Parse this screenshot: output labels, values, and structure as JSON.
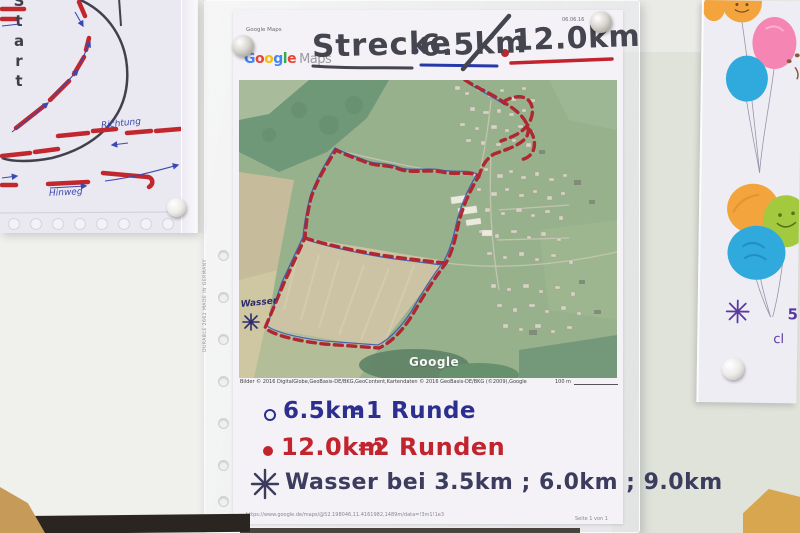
{
  "scene": {
    "description": "Photo of running-event route sheets pinned to a wall",
    "wall_color": "#eaebe7",
    "wall_shaded_color": "#e0e3da",
    "shelf_shadow_color": "#2b2521",
    "wood_corner_color": "#c69b59"
  },
  "left_page": {
    "start_label": "Start",
    "direction_label": "Richtung",
    "outbound_label": "Hinweg",
    "ink_color": "#3f3f4a",
    "route_color": "#c1272d",
    "arrow_color": "#3a49b0"
  },
  "main_page": {
    "print_header": {
      "app_label": "Google Maps",
      "date_label": "06.06.16"
    },
    "logo": {
      "letters": [
        {
          "ch": "G",
          "color": "#4285f4"
        },
        {
          "ch": "o",
          "color": "#ea4335"
        },
        {
          "ch": "o",
          "color": "#fbbc05"
        },
        {
          "ch": "g",
          "color": "#4285f4"
        },
        {
          "ch": "l",
          "color": "#34a853"
        },
        {
          "ch": "e",
          "color": "#ea4335"
        }
      ],
      "maps_label": "Maps",
      "maps_color": "#9b9ba0"
    },
    "title": {
      "route_label": "Strecke",
      "distance_short": "6.5km",
      "distance_long": "12.0km",
      "ink_color": "#45454f",
      "short_color": "#2738a8",
      "long_color": "#c2232f"
    },
    "map": {
      "watermark": "Google",
      "water_label": "Wasser",
      "water_star_icon": "eight-spoke-asterisk",
      "caption": "Bilder © 2016 DigitalGlobe,GeoBasis-DE/BKG,GeoContent,Kartendaten © 2016 GeoBasis-DE/BKG (©2009),Google",
      "scale_label": "100 m",
      "route_color": "#b1202c",
      "gps_track_color": "#3553ae"
    },
    "notes": {
      "row1": {
        "bullet_icon": "ring-bullet",
        "distance": "6.5km",
        "equals": "=",
        "laps": "1 Runde",
        "color": "#2c2f8e"
      },
      "row2": {
        "bullet_icon": "dot-bullet",
        "distance": "12.0km",
        "equals": "=",
        "laps": "2 Runden",
        "color": "#c2242e"
      },
      "row3": {
        "bullet_icon": "eight-spoke-asterisk",
        "text": "Wasser bei 3.5km ; 6.0km ; 9.0km",
        "color": "#3c3c5e"
      }
    },
    "footer": {
      "url": "https://www.google.de/maps/@52.198046,11.4161982,1489m/data=!3m1!1e3",
      "page_label": "Seite 1 von 1"
    },
    "sleeve_brand": "DURABLE 2662 MADE IN GERMANY"
  },
  "right_page": {
    "water_star_icon": "eight-spoke-asterisk",
    "partial_text_top": "5",
    "partial_text_bottom": "cl",
    "balloon_colors": {
      "orange": "#f3a43d",
      "pink": "#f585b3",
      "blue": "#30a9dd",
      "green": "#a3c93f"
    }
  }
}
